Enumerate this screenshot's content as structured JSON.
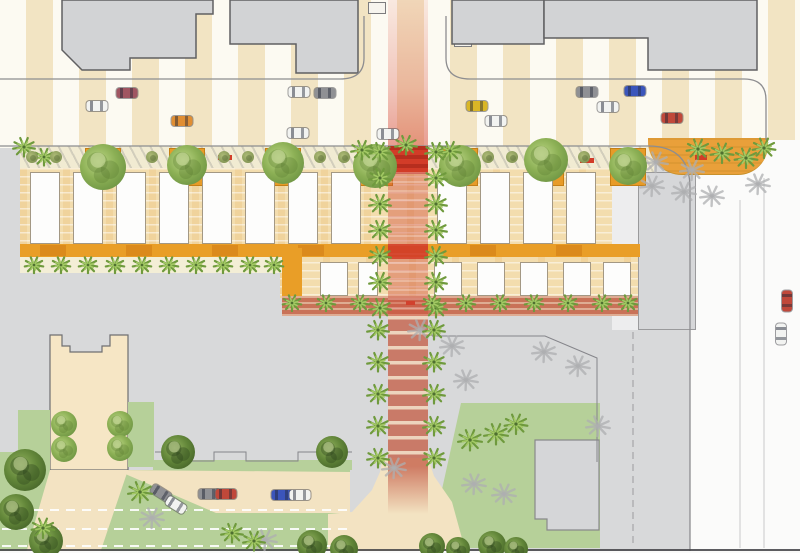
{
  "scene": {
    "w": 800,
    "h": 553,
    "bg": "#d8d9da",
    "description": "aerial-site-plan"
  },
  "palette": {
    "stripe_tan": "#f2e4c3",
    "stripe_white": "#fcfaf2",
    "building_fill": "#d2d3d5",
    "building_stroke": "#606062",
    "curb": "#8d8d90",
    "market_tan": "#f3ddae",
    "orange": "#e99e27",
    "orange_dark": "#d8861b",
    "cream": "#f3eed6",
    "terracotta": "#c97258",
    "red": "#d23c28",
    "lawn": "#b6d099",
    "drive_beige": "#f3e3c2",
    "plaza_beige": "#f6e6c5",
    "street_white": "#fbfbfa",
    "palm_green": "#6f9a3d",
    "palm_light": "#a3c964",
    "shadow_gray": "#aeafb1"
  },
  "layers": {
    "stripe_band": {
      "x": 0,
      "y": 0,
      "w": 800,
      "h": 148
    },
    "right_street": {
      "x": 690,
      "y": 140,
      "w": 110,
      "h": 413,
      "fill": "#fbfbfa"
    },
    "pink_band": {
      "x": 388,
      "y": 0,
      "w": 40,
      "h": 146,
      "from": "rgba(231,133,119,0.15)",
      "to": "rgba(213,66,50,0.5)"
    },
    "sidewalk_strip": {
      "x": 20,
      "y": 146,
      "w": 634,
      "h": 26
    },
    "alley": {
      "x": 612,
      "y": 146,
      "w": 26,
      "h": 184,
      "fill": "#ededee"
    },
    "building_r": {
      "x": 638,
      "y": 172,
      "w": 58,
      "h": 158,
      "fill": "#d6d7d9",
      "stroke": "#9a9a9c"
    },
    "corner_band": {
      "x": 648,
      "y": 138,
      "w": 120,
      "h": 36
    },
    "market_bg": {
      "x": 20,
      "y": 168,
      "w": 592,
      "h": 78
    },
    "ext_bg": {
      "x": 280,
      "y": 246,
      "w": 358,
      "h": 52
    },
    "orange_band": {
      "x": 20,
      "y": 244,
      "w": 620,
      "h": 13,
      "fill": "#e99e27"
    },
    "orange_aisle": {
      "x": 282,
      "y": 248,
      "w": 20,
      "h": 48,
      "fill": "#e99e27"
    },
    "cream_strip": {
      "x": 20,
      "y": 257,
      "w": 262,
      "h": 16,
      "fill": "#f3eed6"
    },
    "terracotta_strip": {
      "x": 282,
      "y": 296,
      "w": 356,
      "h": 20
    },
    "crosswalk": {
      "x": 388,
      "y": 146,
      "w": 40,
      "h": 28
    },
    "paseo_mid": {
      "x": 388,
      "y": 172,
      "w": 40,
      "h": 144
    },
    "red_block": {
      "x": 388,
      "y": 244,
      "w": 40,
      "h": 15,
      "fill": "rgba(210,60,40,0.85)"
    },
    "paseo_south": {
      "x": 388,
      "y": 316,
      "w": 40,
      "h": 150
    },
    "paseo_fade": {
      "x": 388,
      "y": 466,
      "w": 40,
      "h": 48
    }
  },
  "buildings_top": [
    {
      "pts": [
        [
          62,
          0
        ],
        [
          213,
          0
        ],
        [
          213,
          14
        ],
        [
          196,
          14
        ],
        [
          196,
          58
        ],
        [
          130,
          58
        ],
        [
          130,
          70
        ],
        [
          82,
          70
        ],
        [
          62,
          50
        ]
      ]
    },
    {
      "pts": [
        [
          230,
          0
        ],
        [
          358,
          0
        ],
        [
          358,
          73
        ],
        [
          296,
          73
        ],
        [
          296,
          44
        ],
        [
          230,
          44
        ]
      ]
    },
    {
      "pts": [
        [
          452,
          0
        ],
        [
          544,
          0
        ],
        [
          544,
          44
        ],
        [
          452,
          44
        ]
      ]
    },
    {
      "pts": [
        [
          544,
          0
        ],
        [
          757,
          0
        ],
        [
          757,
          70
        ],
        [
          648,
          70
        ],
        [
          648,
          38
        ],
        [
          544,
          38
        ]
      ]
    }
  ],
  "entries": [
    [
      368,
      2,
      18,
      12
    ],
    [
      454,
      36,
      18,
      11
    ]
  ],
  "curbs": [
    "M0,79 H340 Q364,79 364,58 V16",
    "M446,16 V58 Q446,79 470,79 H744 Q766,79 766,100 V140",
    "M0,146 H648 Q690,146 690,188 V553"
  ],
  "lane_lines": [
    {
      "x": 740,
      "y1": 200,
      "y2": 548
    },
    {
      "x": 764,
      "y1": 178,
      "y2": 548
    }
  ],
  "outlines": [
    "M432,336 H545 L597,358 V462",
    "M432,330 V336",
    "M155,452 H182 V461 H214 V452 H246 V461 H298 V452 H352"
  ],
  "dashed_lines": [
    "M633,332 V545"
  ],
  "plaza": {
    "path": "M50,335 H62 V346 H70 V352 H102 V346 H110 V335 H128 V470 H50 Z"
  },
  "lawn_rects": [
    [
      18,
      410,
      32,
      67
    ],
    [
      128,
      402,
      26,
      65
    ],
    [
      0,
      452,
      50,
      101
    ],
    [
      0,
      470,
      350,
      83
    ]
  ],
  "lawn_polys": [
    [
      [
        461,
        403
      ],
      [
        600,
        403
      ],
      [
        600,
        548
      ],
      [
        452,
        548
      ],
      [
        439,
        503
      ]
    ]
  ],
  "green_strip": [
    153,
    460,
    199,
    10
  ],
  "drives": [
    [
      [
        50,
        470
      ],
      [
        128,
        470
      ],
      [
        100,
        553
      ],
      [
        26,
        553
      ]
    ],
    [
      [
        116,
        470
      ],
      [
        350,
        472
      ],
      [
        350,
        513
      ],
      [
        216,
        513
      ]
    ],
    [
      [
        383,
        458
      ],
      [
        428,
        458
      ],
      [
        434,
        476
      ],
      [
        452,
        502
      ],
      [
        466,
        553
      ],
      [
        328,
        553
      ],
      [
        328,
        514
      ],
      [
        352,
        512
      ],
      [
        372,
        490
      ],
      [
        380,
        472
      ]
    ]
  ],
  "building_br": {
    "pts": [
      [
        535,
        440
      ],
      [
        599,
        440
      ],
      [
        599,
        530
      ],
      [
        547,
        530
      ],
      [
        547,
        519
      ],
      [
        535,
        519
      ]
    ],
    "fill": "#d5d6d8",
    "stroke": "#89898b"
  },
  "white_dashes": [
    {
      "x1": 2,
      "x2": 348,
      "y": 510
    },
    {
      "x1": 2,
      "x2": 348,
      "y": 529
    },
    {
      "x1": 2,
      "x2": 348,
      "y": 546
    }
  ],
  "bottom_edge": {
    "line_y": 550,
    "white_y": 551,
    "white_h": 2.5
  },
  "planters": {
    "y": 148,
    "w": 36,
    "h": 38,
    "xs": [
      85,
      169,
      265,
      357,
      442,
      528,
      610
    ]
  },
  "stalls": {
    "row1": {
      "y": 172,
      "h": 72,
      "w": 30,
      "xs": [
        30,
        73,
        116,
        159,
        202,
        245,
        288,
        331,
        437,
        480,
        523,
        566
      ]
    },
    "row2": {
      "y": 262,
      "h": 34,
      "w": 28,
      "xs": [
        320,
        358,
        434,
        477,
        520,
        563,
        603
      ],
      "narrow_index": 1,
      "narrow_w": 20
    }
  },
  "orange_darks": {
    "y": 245,
    "h": 11,
    "w": 26,
    "from": 40,
    "step": 86,
    "to": 600
  },
  "red_dashes": [
    [
      218,
      155,
      14,
      5
    ],
    [
      580,
      158,
      14,
      5
    ],
    [
      695,
      155,
      12,
      5
    ],
    [
      406,
      301,
      9,
      4
    ]
  ],
  "shrubs": {
    "y": 157,
    "r": 6,
    "from": 32,
    "to": 632,
    "step": 24,
    "skip": [
      [
        80,
        128
      ],
      [
        164,
        210
      ],
      [
        260,
        306
      ],
      [
        352,
        440
      ],
      [
        438,
        484
      ],
      [
        524,
        570
      ],
      [
        606,
        650
      ]
    ]
  },
  "trees": [
    [
      103,
      167,
      23,
      "c"
    ],
    [
      187,
      165,
      20,
      "c"
    ],
    [
      283,
      163,
      21,
      "c"
    ],
    [
      375,
      166,
      22,
      "c"
    ],
    [
      460,
      166,
      21,
      "c"
    ],
    [
      546,
      160,
      22,
      "c"
    ],
    [
      628,
      166,
      19,
      "c"
    ],
    [
      64,
      424,
      13,
      "c"
    ],
    [
      64,
      449,
      13,
      "c"
    ],
    [
      120,
      424,
      13,
      "c"
    ],
    [
      120,
      448,
      13,
      "c"
    ],
    [
      178,
      452,
      17,
      "d"
    ],
    [
      332,
      452,
      16,
      "d"
    ],
    [
      25,
      470,
      21,
      "d"
    ],
    [
      16,
      512,
      18,
      "d"
    ],
    [
      46,
      541,
      17,
      "d"
    ],
    [
      312,
      545,
      15,
      "d"
    ],
    [
      344,
      549,
      14,
      "d"
    ],
    [
      432,
      546,
      13,
      "d"
    ],
    [
      458,
      549,
      12,
      "d"
    ],
    [
      492,
      545,
      14,
      "d"
    ],
    [
      516,
      549,
      12,
      "d"
    ]
  ],
  "palms": [
    [
      380,
      152,
      1
    ],
    [
      380,
      178,
      1
    ],
    [
      380,
      204,
      1
    ],
    [
      380,
      230,
      1
    ],
    [
      380,
      256,
      1
    ],
    [
      380,
      282,
      1
    ],
    [
      380,
      308,
      1
    ],
    [
      436,
      152,
      1
    ],
    [
      436,
      178,
      1
    ],
    [
      436,
      204,
      1
    ],
    [
      436,
      230,
      1
    ],
    [
      436,
      256,
      1
    ],
    [
      436,
      282,
      1
    ],
    [
      436,
      308,
      1
    ],
    [
      362,
      150,
      1
    ],
    [
      406,
      145,
      1
    ],
    [
      450,
      151,
      1
    ],
    [
      378,
      330,
      1
    ],
    [
      434,
      330,
      1
    ],
    [
      378,
      362,
      1
    ],
    [
      434,
      362,
      1
    ],
    [
      378,
      394,
      1
    ],
    [
      434,
      394,
      1
    ],
    [
      378,
      426,
      1
    ],
    [
      434,
      426,
      1
    ],
    [
      378,
      458,
      1
    ],
    [
      434,
      458,
      1
    ],
    [
      34,
      265,
      0.85
    ],
    [
      61,
      265,
      0.85
    ],
    [
      88,
      265,
      0.85
    ],
    [
      115,
      265,
      0.85
    ],
    [
      142,
      265,
      0.85
    ],
    [
      169,
      265,
      0.85
    ],
    [
      196,
      265,
      0.85
    ],
    [
      223,
      265,
      0.85
    ],
    [
      250,
      265,
      0.85
    ],
    [
      274,
      265,
      0.85
    ],
    [
      292,
      303,
      0.85
    ],
    [
      326,
      303,
      0.85
    ],
    [
      360,
      303,
      0.85
    ],
    [
      432,
      303,
      0.85
    ],
    [
      466,
      303,
      0.85
    ],
    [
      500,
      303,
      0.85
    ],
    [
      534,
      303,
      0.85
    ],
    [
      568,
      303,
      0.85
    ],
    [
      602,
      303,
      0.85
    ],
    [
      628,
      303,
      0.85
    ],
    [
      698,
      149,
      1.05
    ],
    [
      722,
      153,
      1.05
    ],
    [
      746,
      158,
      1.05
    ],
    [
      764,
      148,
      1.05
    ],
    [
      470,
      440,
      1.1
    ],
    [
      496,
      434,
      1.1
    ],
    [
      516,
      424,
      1.05
    ],
    [
      140,
      492,
      1.1
    ],
    [
      43,
      528,
      1.05
    ],
    [
      232,
      533,
      1
    ],
    [
      254,
      541,
      1
    ],
    [
      24,
      147,
      1
    ],
    [
      44,
      157,
      0.9
    ]
  ],
  "palm_shadows": [
    [
      452,
      346
    ],
    [
      466,
      380
    ],
    [
      544,
      352
    ],
    [
      578,
      366
    ],
    [
      598,
      426
    ],
    [
      474,
      484
    ],
    [
      504,
      494
    ],
    [
      394,
      468
    ],
    [
      420,
      330
    ],
    [
      656,
      162
    ],
    [
      692,
      170
    ],
    [
      758,
      184
    ],
    [
      712,
      196
    ],
    [
      652,
      186
    ],
    [
      684,
      192
    ],
    [
      152,
      518
    ],
    [
      265,
      540
    ]
  ],
  "cars": [
    [
      97,
      106,
      "white",
      0
    ],
    [
      127,
      93,
      "maroon",
      0
    ],
    [
      182,
      121,
      "orange",
      0
    ],
    [
      299,
      92,
      "white",
      0
    ],
    [
      325,
      93,
      "gray",
      0
    ],
    [
      298,
      133,
      "white",
      0
    ],
    [
      388,
      134,
      "white",
      0
    ],
    [
      477,
      106,
      "yellow",
      0
    ],
    [
      496,
      121,
      "white",
      0
    ],
    [
      587,
      92,
      "gray",
      0
    ],
    [
      635,
      91,
      "blue",
      0
    ],
    [
      608,
      107,
      "white",
      0
    ],
    [
      672,
      118,
      "red",
      0
    ],
    [
      787,
      301,
      "red",
      90
    ],
    [
      781,
      334,
      "white",
      90
    ],
    [
      161,
      493,
      "gray",
      32
    ],
    [
      176,
      505,
      "white",
      32
    ],
    [
      209,
      494,
      "gray",
      0
    ],
    [
      226,
      494,
      "red",
      0
    ],
    [
      282,
      495,
      "blue",
      0
    ],
    [
      300,
      495,
      "white",
      0
    ]
  ],
  "car_colors": {
    "white": "#f2f3f1",
    "gray": "#8f9094",
    "red": "#c0483a",
    "maroon": "#a05561",
    "orange": "#e08e33",
    "yellow": "#d9b626",
    "blue": "#3b55bb"
  }
}
